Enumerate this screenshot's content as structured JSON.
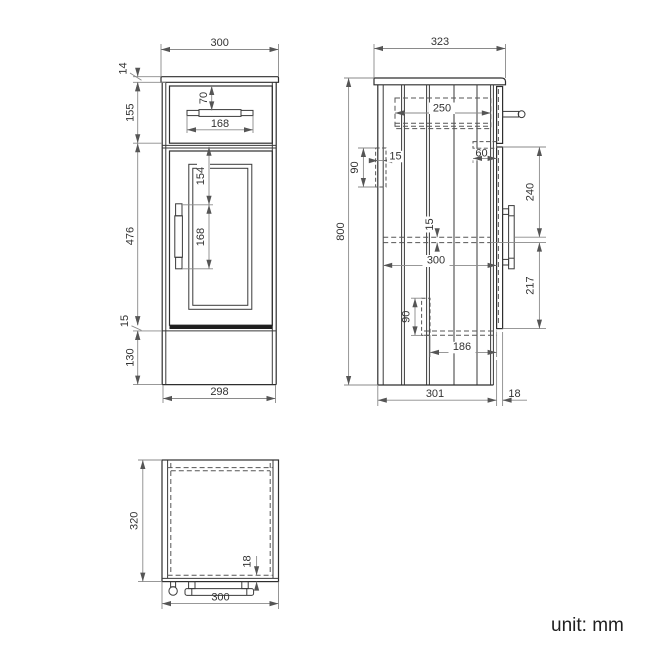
{
  "unit_label": "unit: mm",
  "front_view": {
    "width_top": "300",
    "counter_thickness": "14",
    "drawer_section_height": "155",
    "drawer_handle_offset": "70",
    "drawer_handle_width": "168",
    "door_height": "476",
    "door_top_to_handle": "154",
    "door_handle_length": "168",
    "bottom_gap": "15",
    "plinth_height": "130",
    "width_bottom": "298"
  },
  "side_view": {
    "depth_top": "323",
    "total_height": "800",
    "drawer_depth": "250",
    "back_gap": "15",
    "bracket_top_height": "90",
    "hinge_depth": "60",
    "door_top_to_handle": "240",
    "shelf_thickness": "15",
    "shelf_depth": "300",
    "handle_to_door_bottom": "217",
    "bracket_bottom_height": "90",
    "bottom_rail_depth": "186",
    "depth_bottom": "301",
    "door_thickness": "18"
  },
  "top_view": {
    "depth": "320",
    "door_thickness": "18",
    "width": "300"
  }
}
